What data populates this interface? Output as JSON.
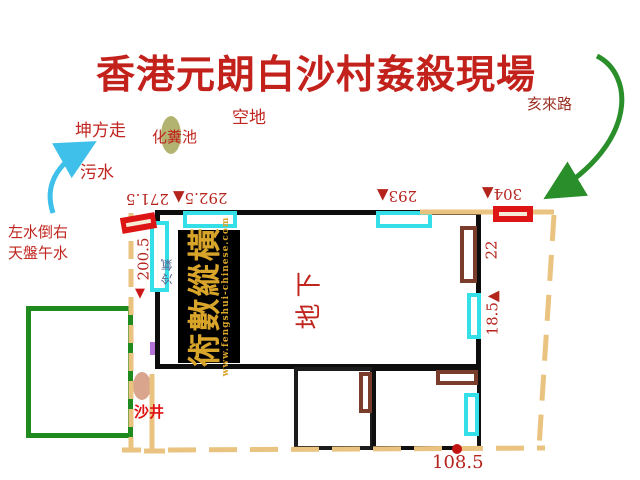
{
  "title": {
    "text": "香港元朗白沙村姦殺現場"
  },
  "labels": {
    "empty_land": "空地",
    "septic_tank": "化糞池",
    "kun_direction": "坤方走",
    "sewage": "污水",
    "water_note_line1": "左水倒右",
    "water_note_line2": "天盤午水",
    "road": "亥來路",
    "manhole": "沙井",
    "ground_floor": "地下",
    "air_conditioner": "冷氣"
  },
  "measurements": {
    "top": [
      "271.5",
      "292.5▲",
      "293▲",
      "304▲"
    ],
    "left_value": "200.5",
    "left_arrow": "▼",
    "right_upper": "22",
    "right_lower": "18.5▲",
    "bottom": "108.5"
  },
  "watermark": {
    "brand": "術數縱橫",
    "url": "www.fengshui-chinese.com"
  },
  "icons": {
    "sewage_flow_arrow": "cyan curved arrow pointing to kun direction",
    "road_approach_arrow": "green curved arrow from Hai direction road to gate"
  },
  "colors": {
    "title_red": "#c3221c",
    "label_red": "#c0251f",
    "measure_red": "#b5231d",
    "dark_red": "#9c2f23",
    "wall_black": "#0d0d0d",
    "boundary_tan": "#e9c37f",
    "yard_green": "#1f8b1f",
    "arrow_green": "#2a8f2a",
    "window_cyan": "#35dfe8",
    "arrow_cyan": "#3ec0ea",
    "door_brown": "#7a3c2b",
    "gate_red": "#dd1515",
    "watermark_gold": "#d9a42a",
    "manhole_salmon": "#d9a58d",
    "septic_olive": "#b3b371",
    "purple_mark": "#b473d6"
  }
}
